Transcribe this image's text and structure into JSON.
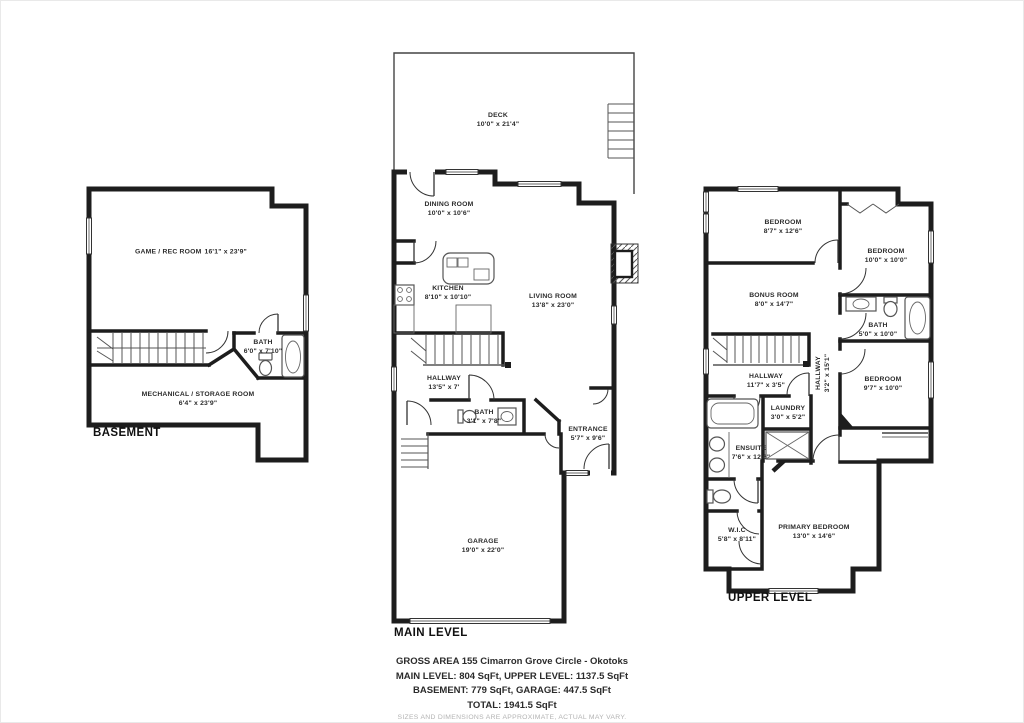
{
  "levels": {
    "basement": {
      "label": "BASEMENT",
      "rooms": [
        {
          "name": "GAME / REC ROOM",
          "dims": "16'1\" x 23'9\""
        },
        {
          "name": "BATH",
          "dims": "6'0\" x 7'10\""
        },
        {
          "name": "MECHANICAL / STORAGE ROOM",
          "dims": "6'4\" x 23'9\""
        }
      ]
    },
    "main": {
      "label": "MAIN LEVEL",
      "rooms": [
        {
          "name": "DECK",
          "dims": "10'0\" x 21'4\""
        },
        {
          "name": "DINING ROOM",
          "dims": "10'0\" x 10'6\""
        },
        {
          "name": "KITCHEN",
          "dims": "8'10\" x 10'10\""
        },
        {
          "name": "LIVING ROOM",
          "dims": "13'8\" x 23'0\""
        },
        {
          "name": "HALLWAY",
          "dims": "13'5\" x 7'"
        },
        {
          "name": "BATH",
          "dims": "3'1\" x 7'8\""
        },
        {
          "name": "ENTRANCE",
          "dims": "5'7\" x 9'6\""
        },
        {
          "name": "GARAGE",
          "dims": "19'0\" x 22'0\""
        }
      ]
    },
    "upper": {
      "label": "UPPER LEVEL",
      "rooms": [
        {
          "name": "BEDROOM",
          "dims": "8'7\" x 12'6\""
        },
        {
          "name": "BEDROOM",
          "dims": "10'0\" x 10'0\""
        },
        {
          "name": "BONUS ROOM",
          "dims": "8'0\" x 14'7\""
        },
        {
          "name": "BATH",
          "dims": "5'0\" x 10'0\""
        },
        {
          "name": "HALLWAY",
          "dims": "11'7\" x 3'5\""
        },
        {
          "name": "HALLWAY",
          "dims": "3'2\" x 15'1\""
        },
        {
          "name": "LAUNDRY",
          "dims": "3'0\" x 5'2\""
        },
        {
          "name": "BEDROOM",
          "dims": "9'7\" x 10'0\""
        },
        {
          "name": "ENSUITE",
          "dims": "7'6\" x 12'6\""
        },
        {
          "name": "W.I.C",
          "dims": "5'8\" x 8'11\""
        },
        {
          "name": "PRIMARY BEDROOM",
          "dims": "13'0\" x 14'6\""
        }
      ]
    }
  },
  "footer": {
    "line1": "GROSS AREA 155 Cimarron Grove Circle - Okotoks",
    "line2": "MAIN LEVEL: 804 SqFt, UPPER LEVEL: 1137.5 SqFt",
    "line3": "BASEMENT: 779 SqFt, GARAGE: 447.5 SqFt",
    "line4": "TOTAL: 1941.5 SqFt",
    "disclaimer": "SIZES AND DIMENSIONS ARE APPROXIMATE, ACTUAL MAY VARY."
  }
}
